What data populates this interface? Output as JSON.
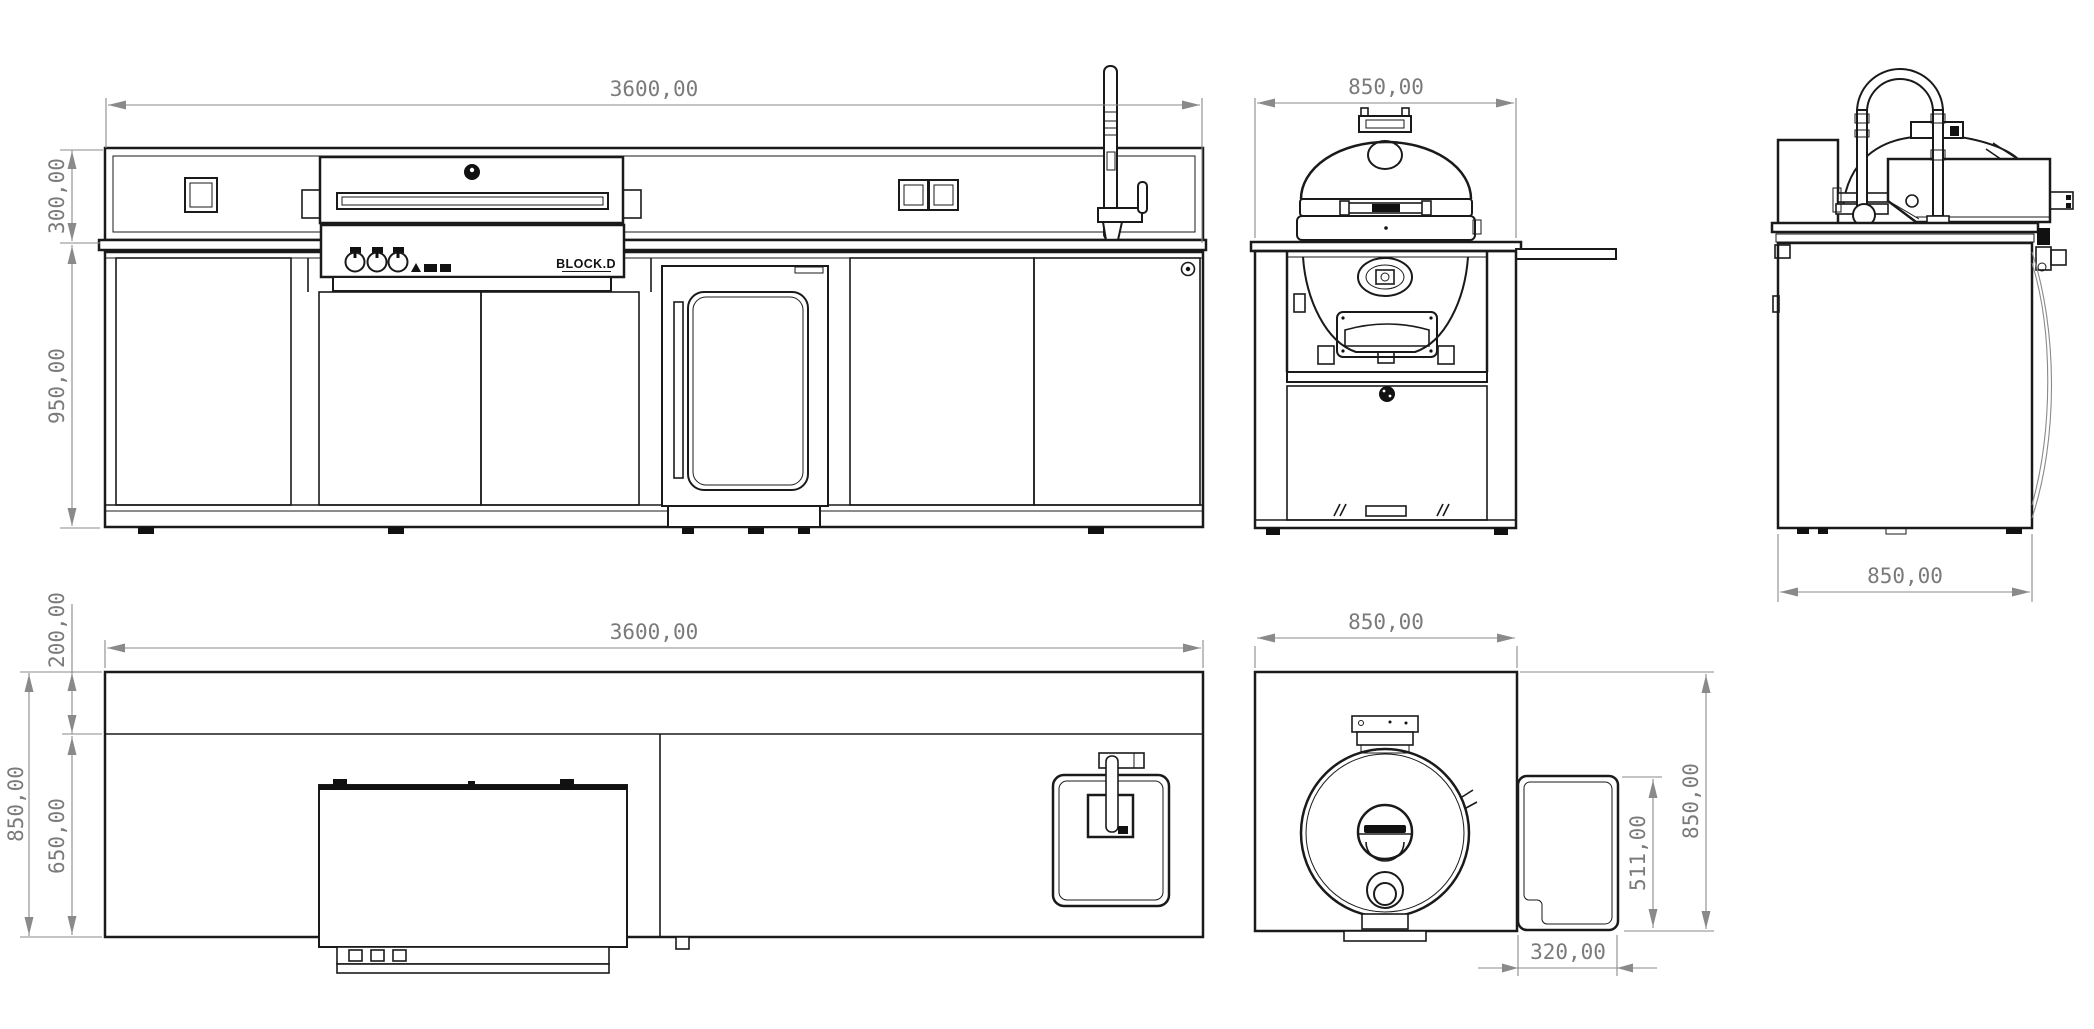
{
  "drawing": {
    "type": "technical-drawing",
    "subject": "BLOCK.D outdoor kitchen island with kamado module",
    "units_format": "millimeters with comma decimals"
  },
  "brand": {
    "label": "BLOCK.D"
  },
  "colors": {
    "background": "#ffffff",
    "line": "#1a1a1a",
    "dimension": "#7a7a7a"
  },
  "icons": {
    "grill_logo": "round-brand-badge",
    "door_badge": "round-brand-badge",
    "knobs": "burner-control-knob",
    "thermometer": "dome-thermometer"
  },
  "views": {
    "front": {
      "label": "front elevation",
      "width": "3600,00",
      "backsplash_height": "300,00",
      "body_height": "950,00"
    },
    "kamado_front": {
      "label": "kamado module elevation",
      "width": "850,00"
    },
    "side": {
      "label": "side elevation",
      "depth": "850,00"
    },
    "plan": {
      "label": "island plan view",
      "width": "3600,00",
      "backsplash_depth": "200,00",
      "total_depth": "850,00",
      "counter_depth": "650,00"
    },
    "kamado_plan": {
      "label": "kamado module plan view",
      "width": "850,00",
      "depth": "850,00",
      "side_shelf_depth": "511,00",
      "side_shelf_width": "320,00"
    }
  }
}
